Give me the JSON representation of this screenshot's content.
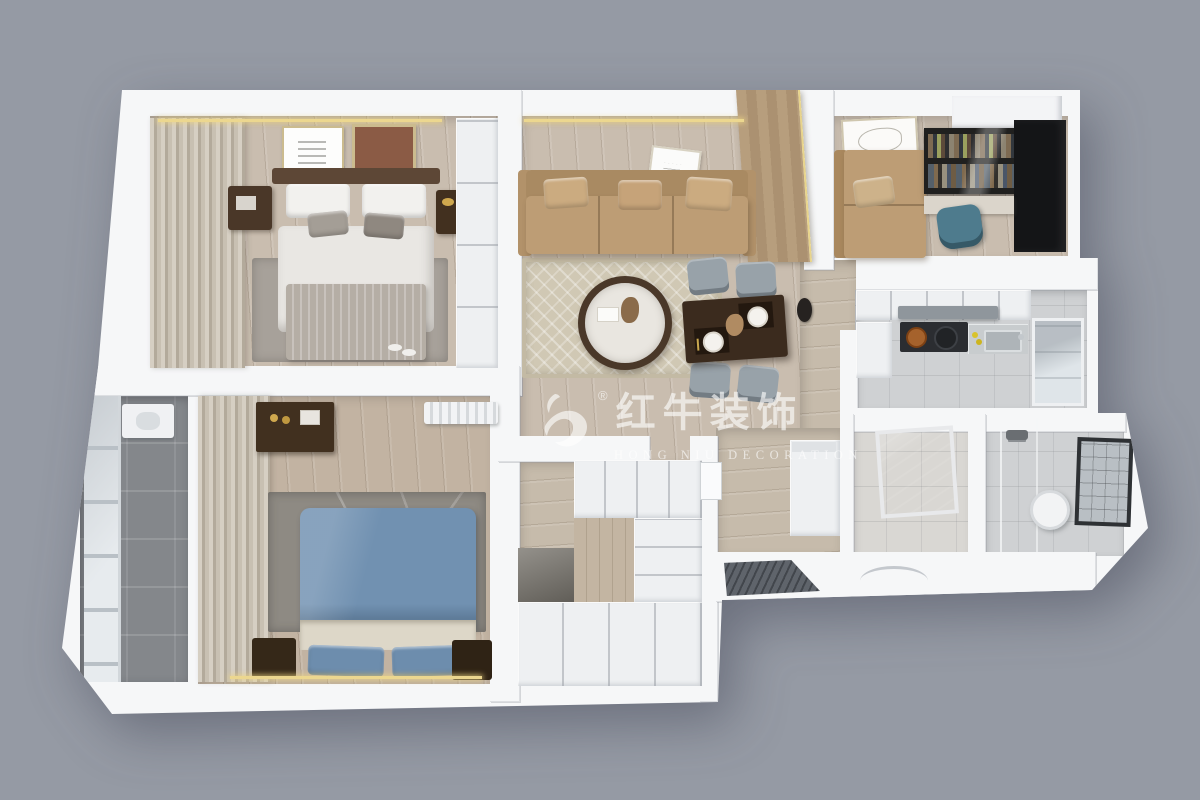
{
  "canvas": {
    "width": 1200,
    "height": 800,
    "background_color": "#959aa4"
  },
  "watermark": {
    "logo": "bull-logo",
    "registered_mark": "®",
    "title_cn": "红牛装饰",
    "subtitle_en": "HONG NIU DECORATION",
    "color": "rgba(255,255,255,0.62)"
  },
  "palette": {
    "wall": "#f6f7f8",
    "wood_floor": "#c9bdaf",
    "balcony_tile": "#84878b",
    "tan_leather": "#bd9d75",
    "dark_wood": "#43301f",
    "espresso_table": "#3b2b1e",
    "gray_fabric": "#98a2a9",
    "blue_bed": "#7191b1",
    "cream_blanket": "#ddd7c8",
    "gold_led_strip": "#ecd78f",
    "teal_chair": "#4e7b8d",
    "black_cabinet": "#141517",
    "wood_accent_wall": "#b39a78",
    "rug_beige": "#d0c8b4",
    "rug_gray": "#8e8a83"
  },
  "scene": {
    "view": "3d-top-down-apartment-floor-plan",
    "rooms": [
      {
        "id": "master-bedroom",
        "items": [
          "double-bed",
          "nightstand-left",
          "nightstand-right",
          "wall-art-poster",
          "wall-art-rust",
          "wardrobe",
          "curtains",
          "rug",
          "slippers",
          "led-strip"
        ]
      },
      {
        "id": "living-dining-room",
        "items": [
          "leather-sofa",
          "sofa-pillows",
          "coffee-table",
          "area-rug",
          "dining-table",
          "dining-chairs-x4",
          "plates",
          "wall-art",
          "wood-accent-wall",
          "wall-clock",
          "led-strip"
        ]
      },
      {
        "id": "study",
        "items": [
          "leather-daybed",
          "wall-art-sketch",
          "bookshelf-glass",
          "desk",
          "office-chair-teal",
          "black-wardrobe",
          "corner-soffit"
        ]
      },
      {
        "id": "kitchen",
        "items": [
          "upper-cabinets",
          "range-hood",
          "cooktop",
          "copper-pot",
          "black-pot",
          "counter",
          "sink",
          "lemons",
          "window",
          "tall-cabinet"
        ]
      },
      {
        "id": "second-bedroom",
        "items": [
          "double-bed-blue",
          "cream-blanket",
          "dresser",
          "nightstand-left",
          "nightstand-right",
          "radiator",
          "curtains",
          "rug",
          "led-strip"
        ]
      },
      {
        "id": "balcony",
        "items": [
          "glazed-windows",
          "wash-basin-unit"
        ]
      },
      {
        "id": "entry-hall",
        "items": [
          "shoe-cabinet",
          "interior-door",
          "door-mat",
          "entry-door-handle"
        ]
      },
      {
        "id": "cloakroom",
        "items": [
          "wardrobe-cabinets",
          "mirror",
          "lower-cabinets"
        ]
      },
      {
        "id": "utility-room",
        "items": [
          "dark-window"
        ]
      },
      {
        "id": "bathroom",
        "items": [
          "shower-glass",
          "shower-head",
          "water-heater",
          "framed-window"
        ]
      }
    ]
  }
}
